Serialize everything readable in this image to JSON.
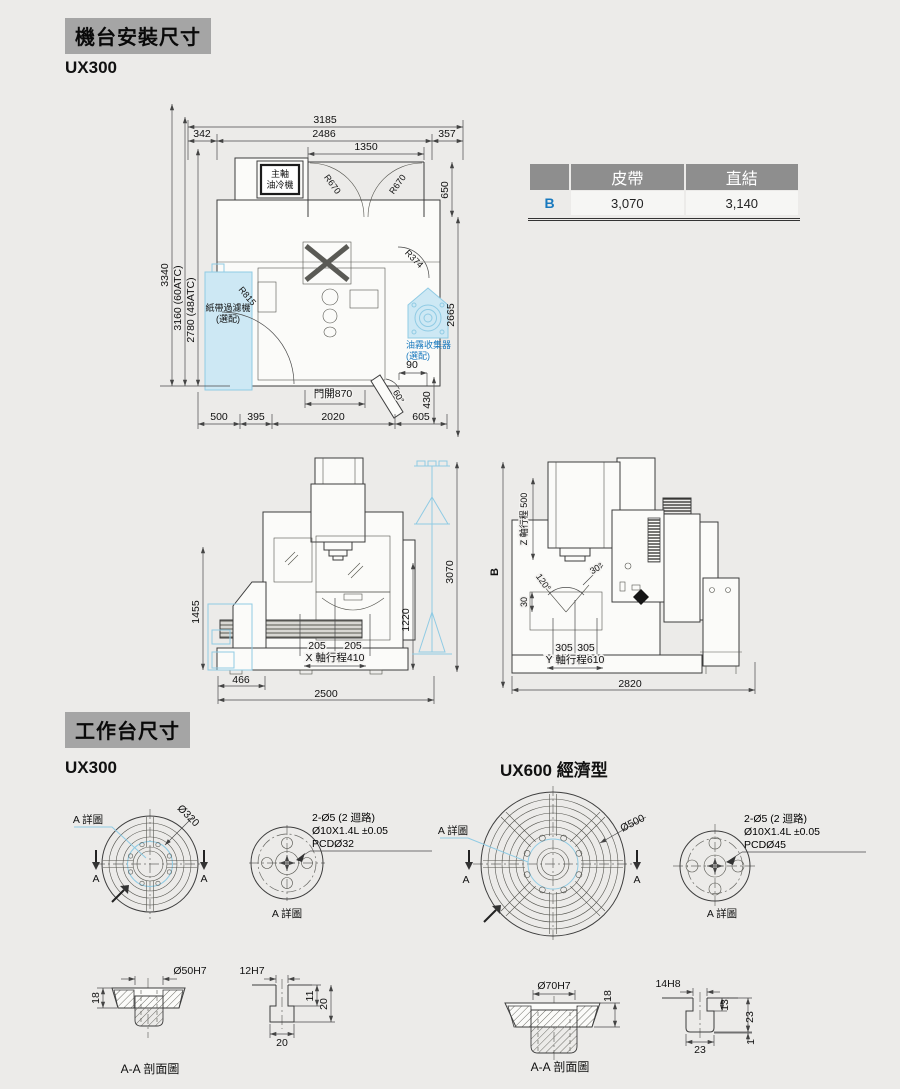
{
  "sections": {
    "install": {
      "title": "機台安裝尺寸",
      "model": "UX300"
    },
    "worktable": {
      "title": "工作台尺寸",
      "model_left": "UX300",
      "model_right": "UX600 經濟型"
    }
  },
  "colors": {
    "accent_blue": "#1879be",
    "light_blue_fill": "#cde8f4",
    "badge_gray": "#a5a5a5",
    "table_header_gray": "#8e8e8e"
  },
  "spec_table": {
    "col_belt": "皮帶",
    "col_direct": "直結",
    "row_label": "B",
    "belt_value": "3,070",
    "direct_value": "3,140"
  },
  "top_view": {
    "w3185": "3185",
    "w342": "342",
    "w2486": "2486",
    "w357": "357",
    "w1350": "1350",
    "h650": "650",
    "r670a": "R670",
    "r670b": "R670",
    "r374": "R374",
    "r815": "R815",
    "h3340": "3340",
    "h3160": "3160 (60ATC)",
    "h2780": "2780 (48ATC)",
    "d2665": "2665",
    "d90": "90",
    "a60": "60°",
    "d430": "430",
    "door": "門開870",
    "d500": "500",
    "d395": "395",
    "d2020": "2020",
    "d605": "605",
    "oil1": "主軸",
    "oil2": "油冷機",
    "filter1": "紙帶過濾機",
    "filter2": "(選配)",
    "mist1": "油霧收集器",
    "mist2": "(選配)"
  },
  "front_view": {
    "h1455": "1455",
    "w466": "466",
    "w2500": "2500",
    "x205a": "205",
    "x205b": "205",
    "x_stroke": "X 軸行程410",
    "h1220": "1220",
    "hoist3070": "3070"
  },
  "side_view": {
    "b": "B",
    "z_stroke": "Z 軸行程 500",
    "a120": "120°",
    "a30": "30°",
    "d30": "30",
    "y305a": "305",
    "y305b": "305",
    "y_stroke": "Y 軸行程610",
    "w2820": "2820"
  },
  "ux300_table": {
    "dia": "Ø320",
    "detail_callout": "A 詳圖",
    "a_left": "A",
    "a_right": "A",
    "note1": "2-Ø5 (2 迴路)",
    "note2": "Ø10X1.4L ±0.05",
    "note3": "PCDØ32",
    "detail_caption": "A 詳圖",
    "bore": "Ø50H7",
    "depth": "18",
    "slot": "12H7",
    "s11": "11",
    "s20r": "20",
    "s20b": "20",
    "section_caption": "A-A 剖面圖"
  },
  "ux600_table": {
    "dia": "Ø500",
    "detail_callout": "A 詳圖",
    "a_left": "A",
    "a_right": "A",
    "note1": "2-Ø5 (2 迴路)",
    "note2": "Ø10X1.4L ±0.05",
    "note3": "PCDØ45",
    "detail_caption": "A 詳圖",
    "bore": "Ø70H7",
    "depth": "18",
    "slot": "14H8",
    "s13": "13",
    "s23r": "23",
    "s1": "1",
    "s23b": "23",
    "section_caption": "A-A 剖面圖"
  }
}
